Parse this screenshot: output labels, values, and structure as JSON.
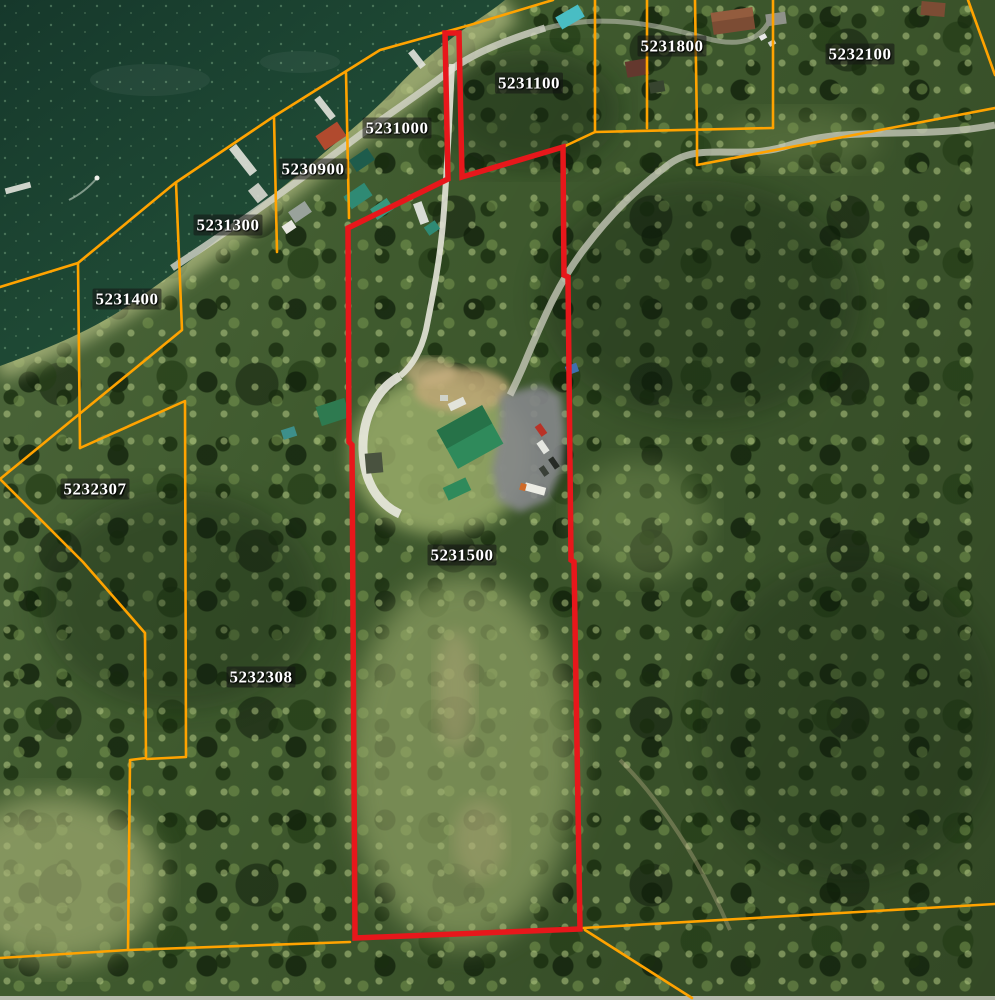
{
  "map": {
    "title": "Aerial parcel map",
    "selected_parcel": "5231500",
    "colors": {
      "parcel_line": "#FFA300",
      "selected_outline": "#E7171B",
      "label_text": "#FFFFFF",
      "label_bg": "rgba(20,20,20,0.55)",
      "water": "#1A4031"
    },
    "parcel_labels": [
      {
        "text": "5231000",
        "x": 397,
        "y": 128
      },
      {
        "text": "5230900",
        "x": 313,
        "y": 169
      },
      {
        "text": "5231100",
        "x": 529,
        "y": 83
      },
      {
        "text": "5231800",
        "x": 672,
        "y": 46
      },
      {
        "text": "5232100",
        "x": 860,
        "y": 54
      },
      {
        "text": "5231300",
        "x": 228,
        "y": 225
      },
      {
        "text": "5231400",
        "x": 127,
        "y": 299
      },
      {
        "text": "5232307",
        "x": 95,
        "y": 489
      },
      {
        "text": "5231500",
        "x": 462,
        "y": 555
      },
      {
        "text": "5232308",
        "x": 261,
        "y": 677
      }
    ]
  }
}
